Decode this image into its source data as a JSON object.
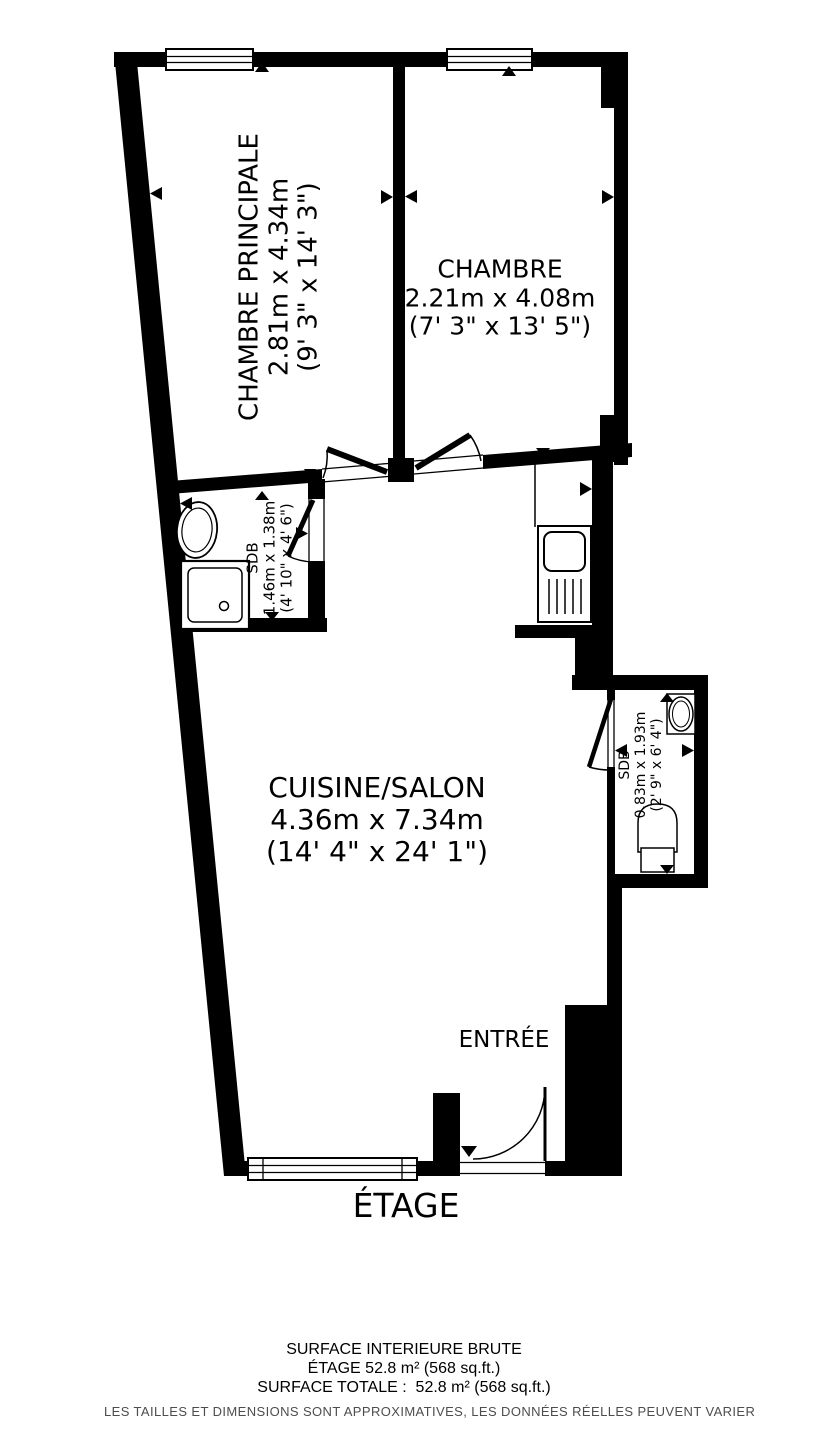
{
  "rooms": {
    "chambre_principale": {
      "name": "CHAMBRE PRINCIPALE",
      "dimensions_metric": "2.81m x 4.34m",
      "dimensions_imperial": "(9' 3\" x 14' 3\")"
    },
    "chambre": {
      "name": "CHAMBRE",
      "dimensions_metric": "2.21m x 4.08m",
      "dimensions_imperial": "(7' 3\" x 13' 5\")"
    },
    "sdb_1": {
      "name": "SDB",
      "dimensions_metric": "1.46m x 1.38m",
      "dimensions_imperial": "(4' 10\" x 4' 6\")"
    },
    "cuisine_salon": {
      "name": "CUISINE/SALON",
      "dimensions_metric": "4.36m x 7.34m",
      "dimensions_imperial": "(14' 4\" x 24' 1\")"
    },
    "sdb_2": {
      "name": "SDB",
      "dimensions_metric": "0.83m x 1.93m",
      "dimensions_imperial": "(2' 9\" x 6' 4\")"
    },
    "entree": {
      "name": "ENTRÉE"
    }
  },
  "floor_label": "ÉTAGE",
  "footer": {
    "line1": "SURFACE INTERIEURE BRUTE",
    "line2": "ÉTAGE 52.8 m² (568 sq.ft.)",
    "line3": "SURFACE TOTALE :  52.8 m² (568 sq.ft.)",
    "disclaimer": "LES TAILLES ET DIMENSIONS SONT APPROXIMATIVES, LES DONNÉES RÉELLES PEUVENT VARIER"
  },
  "colors": {
    "walls": "#000000",
    "background": "#ffffff",
    "disclaimer_text": "#4d4d4d"
  }
}
